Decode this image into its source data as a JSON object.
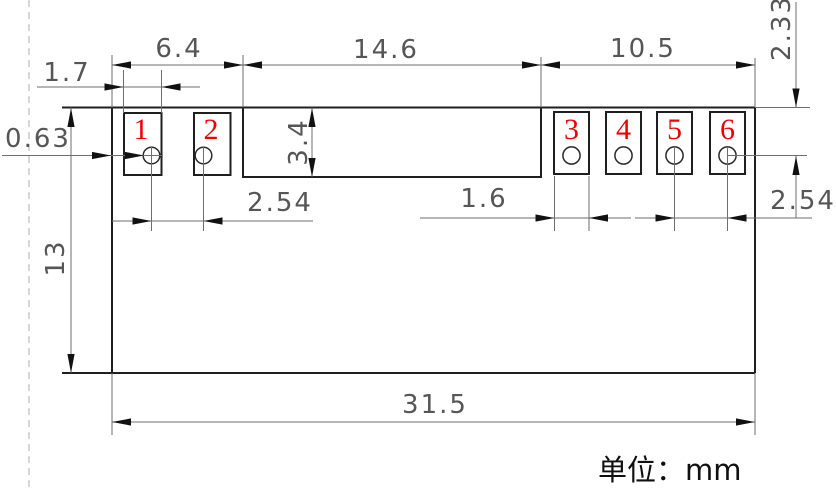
{
  "unit_note": "单位：mm",
  "pads": [
    {
      "number": "1"
    },
    {
      "number": "2"
    },
    {
      "number": "3"
    },
    {
      "number": "4"
    },
    {
      "number": "5"
    },
    {
      "number": "6"
    }
  ],
  "dims": {
    "left_section_width": "6.4",
    "center_section_width": "14.6",
    "right_section_width": "10.5",
    "pad_width_left": "1.7",
    "pin_diameter": "0.63",
    "body_height": "13",
    "notch_height": "3.4",
    "pin_pitch_left": "2.54",
    "pad_width_right": "1.6",
    "pin_pitch_right": "2.54",
    "pin_top_offset": "2.33",
    "total_width": "31.5"
  },
  "colors": {
    "outline": "#1f1f1f",
    "dimension_line": "#6e6e6e",
    "dimension_text": "#565656",
    "arrow": "#111111",
    "pad_number": "#f40000",
    "construction_line": "#bcbcbc",
    "background": "#ffffff"
  }
}
